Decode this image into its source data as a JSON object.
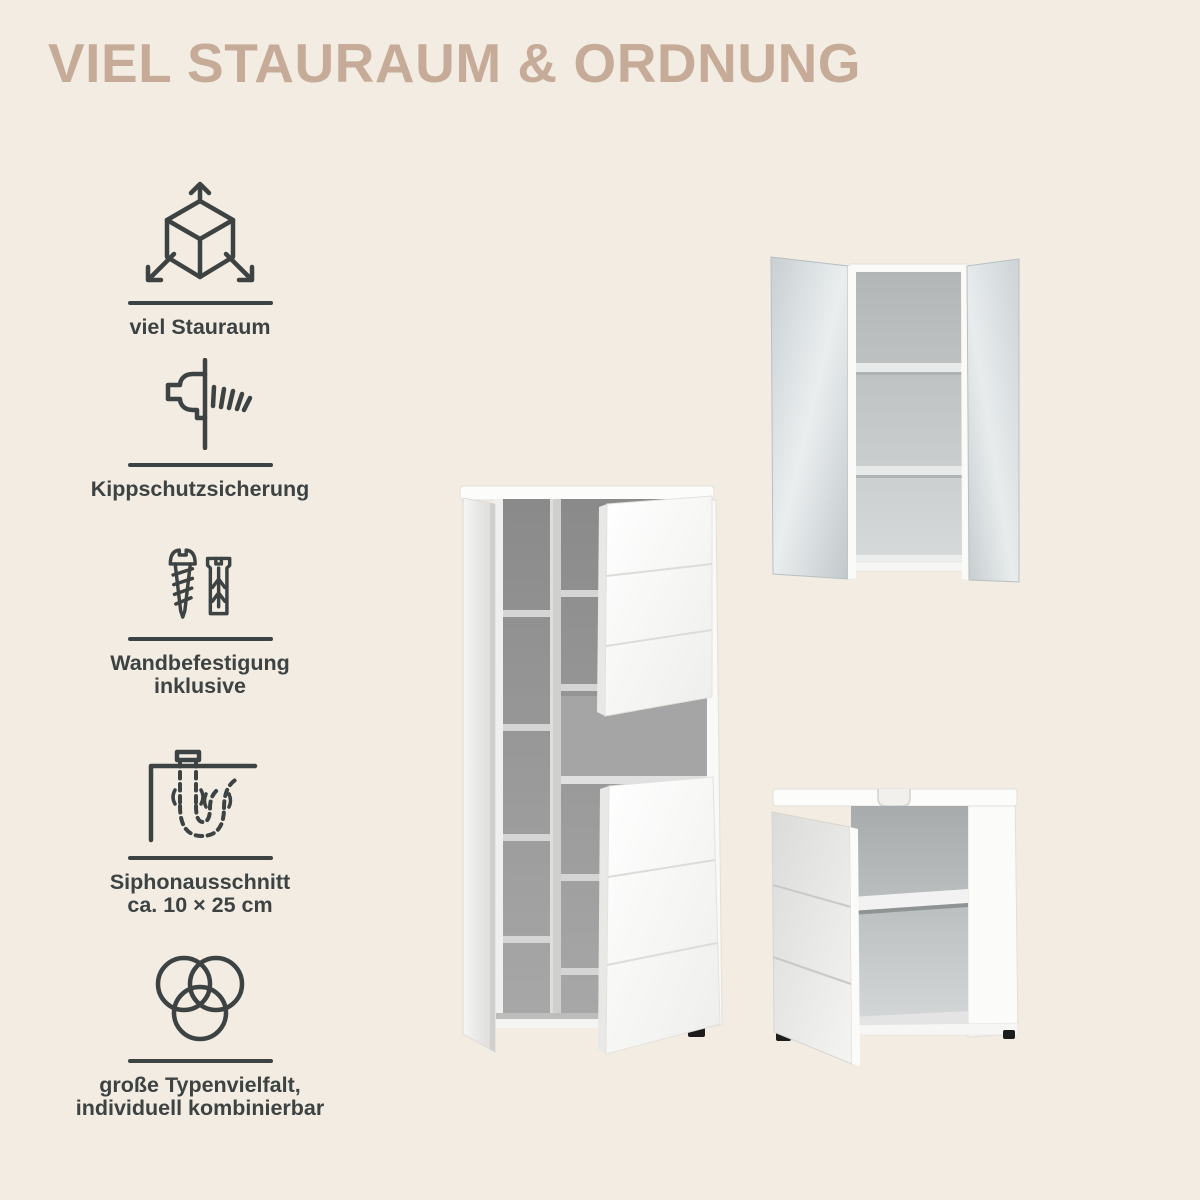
{
  "page": {
    "title": "VIEL STAURAUM & ORDNUNG",
    "background_color": "#f2ece2",
    "title_color": "#c6ac98",
    "ink_color": "#3d4242"
  },
  "features": [
    {
      "icon": "storage-volume-cube-icon",
      "label": "viel Stauraum"
    },
    {
      "icon": "anti-tip-screw-icon",
      "label": "Kippschutzsicherung"
    },
    {
      "icon": "wall-mounting-screw-dowel-icon",
      "label": "Wandbefestigung\ninklusive"
    },
    {
      "icon": "siphon-cutout-icon",
      "label": "Siphonausschnitt\nca. 10 × 25 cm"
    },
    {
      "icon": "variety-circles-icon",
      "label": "große Typenvielfalt,\nindividuell kombinierbar"
    }
  ],
  "products": [
    {
      "name": "tall-storage-cabinet-open"
    },
    {
      "name": "mirror-wall-cabinet-open"
    },
    {
      "name": "sink-base-cabinet-open"
    }
  ]
}
